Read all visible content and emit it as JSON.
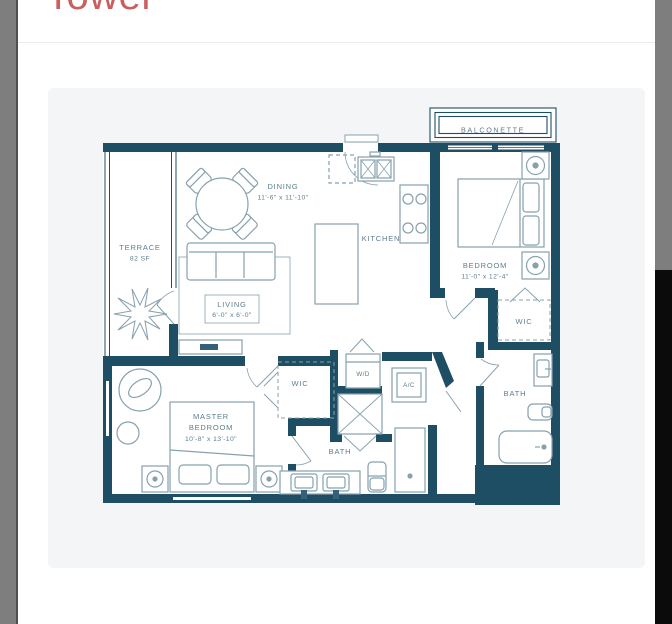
{
  "window": {
    "heading": "Tower"
  },
  "floorplan": {
    "balconette": {
      "name": "BALCONETTE"
    },
    "terrace": {
      "name": "TERRACE",
      "area": "82 SF"
    },
    "dining": {
      "name": "DINING",
      "dims": "11'-6\" x 11'-10\""
    },
    "kitchen": {
      "name": "KITCHEN"
    },
    "bedroom": {
      "name": "BEDROOM",
      "dims": "11'-0\" x 12'-4\""
    },
    "living": {
      "name": "LIVING",
      "dims": "6'-0\" x 6'-0\""
    },
    "wic_right": {
      "name": "WIC"
    },
    "wic_center": {
      "name": "WIC"
    },
    "washer_dryer": {
      "name": "W/D"
    },
    "ac": {
      "name": "A/C"
    },
    "bath": {
      "name": "BATH"
    },
    "master_bath": {
      "name": "BATH"
    },
    "master_bedroom": {
      "name_line1": "MASTER",
      "name_line2": "BEDROOM",
      "dims": "10'-8\" x 13'-10\""
    }
  },
  "colors": {
    "wall": "#1d4e63",
    "furniture_line": "#87a1ae",
    "label_text": "#5d7e8f",
    "heading_red": "#c96060",
    "card_background": "#f3f5f7",
    "side_bar_gray": "#7e7e7e",
    "side_bar_black": "#0b0b0b"
  }
}
